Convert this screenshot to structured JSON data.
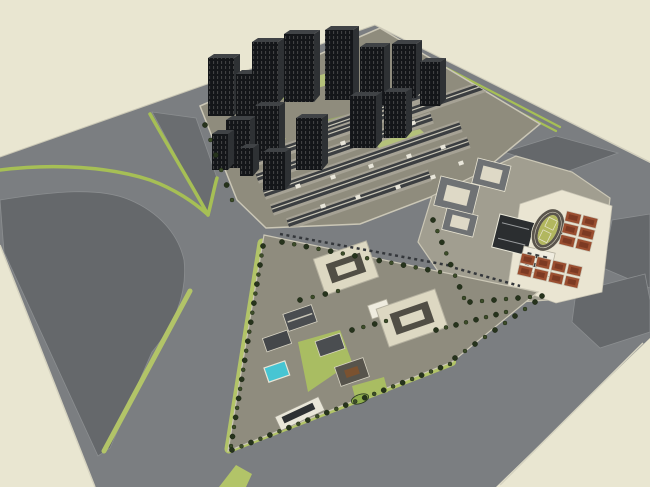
{
  "app": {
    "name": "3d-site-model-viewport",
    "description": "SketchUp-style aerial render of an urban master plan on a beige ground",
    "canvas": {
      "width": 650,
      "height": 487
    }
  },
  "districts": [
    {
      "id": "highrise-residential",
      "label": "high-rise residential tower cluster"
    },
    {
      "id": "lowrise-residential",
      "label": "dense low-rise courtyard housing"
    },
    {
      "id": "school-campus",
      "label": "school campus with running track and red courts"
    },
    {
      "id": "mixed-use-triangle",
      "label": "triangular tree-lined mixed-use district"
    },
    {
      "id": "vacant-parcels",
      "label": "vacant graded parcels with green verges"
    }
  ],
  "palette": {
    "background": "#e9e6d1",
    "road": "#7b7e81",
    "parcel": "#65686b",
    "wedge": "#6a6d70",
    "sidewalk": "#cbc7b6",
    "curb": "#d6d3c0",
    "green_strip": "#a6bf55",
    "green_band": "#b2c468",
    "lawn": "#a9bd62",
    "lawn_dark": "#8fae4c",
    "tree": "#26331c",
    "tree2": "#3d4d29",
    "tower_front": "#141619",
    "tower_side": "#2e3134",
    "tower_roof": "#404346",
    "tower_stripe": "#d8dbd3",
    "res_ground": "#8f8c7d",
    "lowrise_light": "#a6a295",
    "lowrise_dark": "#3b3e41",
    "ridge": "#c8c5b6",
    "speck": "#e9e6da",
    "court_green": "#9aa868",
    "court_green2": "#b4c17a",
    "school_ground": "#a19e90",
    "apron": "#eae5d2",
    "roof_gray": "#6f7274",
    "cream": "#ded9c6",
    "gym": "#2b2e30",
    "white": "#efecdf",
    "track_ring": "#5a554c",
    "infield": "#b2b75f",
    "track_line": "#e9e5d2",
    "court_red": "#9a4e30",
    "court_red_dark": "#7c3a23",
    "bot_ground": "#8f8c7e",
    "bld_cream": "#ddd8c2",
    "bld_edge": "#b5b1a0",
    "courtyard": "#514e45",
    "roof_dark": "#4a4d50",
    "pool": "#47c5d3",
    "wood": "#7b5230",
    "win_dark": "#2e3133",
    "dash": "#34373b"
  },
  "scene": {
    "towers": [
      [
        208,
        58,
        26,
        58
      ],
      [
        236,
        74,
        20,
        48
      ],
      [
        252,
        42,
        26,
        62
      ],
      [
        284,
        34,
        30,
        68
      ],
      [
        325,
        30,
        28,
        70
      ],
      [
        360,
        47,
        24,
        58
      ],
      [
        392,
        44,
        24,
        54
      ],
      [
        420,
        62,
        20,
        44
      ],
      [
        226,
        120,
        24,
        48
      ],
      [
        255,
        106,
        24,
        54
      ],
      [
        296,
        118,
        26,
        52
      ],
      [
        350,
        96,
        26,
        52
      ],
      [
        384,
        92,
        22,
        46
      ],
      [
        263,
        152,
        22,
        38
      ],
      [
        212,
        134,
        16,
        36
      ],
      [
        240,
        148,
        13,
        28
      ]
    ],
    "green_patches": [
      {
        "pts": "240,100 285,88 296,96 251,108",
        "f": "court_green"
      },
      {
        "pts": "302,80 346,68 358,76 314,89",
        "f": "court_green2"
      },
      {
        "pts": "230,141 274,129 286,139 242,152",
        "f": "court_green2"
      },
      {
        "pts": "321,121 369,109 380,119 333,131",
        "f": "court_green"
      },
      {
        "pts": "372,141 420,129 431,139 383,152",
        "f": "court_green2"
      },
      {
        "pts": "395,70 430,60 438,68 403,79",
        "f": "court_green"
      }
    ],
    "lowrise_rows": [
      [
        320,
        130,
        130
      ],
      [
        392,
        118,
        118
      ],
      [
        250,
        162,
        150
      ],
      [
        257,
        178,
        185
      ],
      [
        264,
        194,
        208
      ],
      [
        272,
        210,
        208
      ],
      [
        288,
        224,
        150
      ]
    ],
    "roof_specks": [
      [
        300,
        150
      ],
      [
        340,
        142
      ],
      [
        372,
        130
      ],
      [
        410,
        122
      ],
      [
        295,
        185
      ],
      [
        330,
        176
      ],
      [
        368,
        165
      ],
      [
        406,
        155
      ],
      [
        440,
        146
      ],
      [
        320,
        205
      ],
      [
        355,
        196
      ],
      [
        395,
        186
      ],
      [
        430,
        176
      ],
      [
        458,
        162
      ]
    ],
    "tree_rows": [
      [
        263,
        246,
        231,
        446,
        22
      ],
      [
        232,
        450,
        450,
        364,
        24
      ],
      [
        433,
        220,
        464,
        298,
        8
      ],
      [
        282,
        242,
        440,
        272,
        14
      ],
      [
        436,
        330,
        506,
        312,
        8
      ],
      [
        470,
        302,
        542,
        296,
        7
      ],
      [
        455,
        358,
        535,
        302,
        9
      ],
      [
        205,
        125,
        232,
        200,
        6
      ],
      [
        300,
        300,
        338,
        291,
        4
      ],
      [
        352,
        330,
        386,
        321,
        4
      ]
    ],
    "court_grids": [
      {
        "x": 567,
        "y": 211,
        "cols": 2,
        "rows": 3,
        "cw": 15,
        "ch": 10,
        "gap": 2,
        "rot": 14
      },
      {
        "x": 522,
        "y": 253,
        "cols": 4,
        "rows": 2,
        "cw": 14,
        "ch": 10,
        "gap": 2,
        "rot": 13
      }
    ],
    "green_strips": [
      {
        "d": "M0,170 C55,163 110,167 150,180 C175,189 195,203 207,214",
        "w": 3.5,
        "c": "green_strip"
      },
      {
        "d": "M150,114 C170,150 195,190 208,215",
        "w": 3.5,
        "c": "green_strip"
      },
      {
        "d": "M208,215 C212,200 214,188 217,178",
        "w": 3.5,
        "c": "green_strip"
      },
      {
        "d": "M400,44 L560,127",
        "w": 2.2,
        "c": "green_strip"
      },
      {
        "d": "M400,50 L556,131",
        "w": 2.2,
        "c": "green_strip"
      },
      {
        "d": "M190,291 L104,451",
        "w": 5,
        "c": "green_band"
      },
      {
        "d": "M262,243 L229,449",
        "w": 9,
        "c": "green_band"
      },
      {
        "d": "M229,449 L452,362",
        "w": 8,
        "c": "green_band"
      }
    ]
  }
}
